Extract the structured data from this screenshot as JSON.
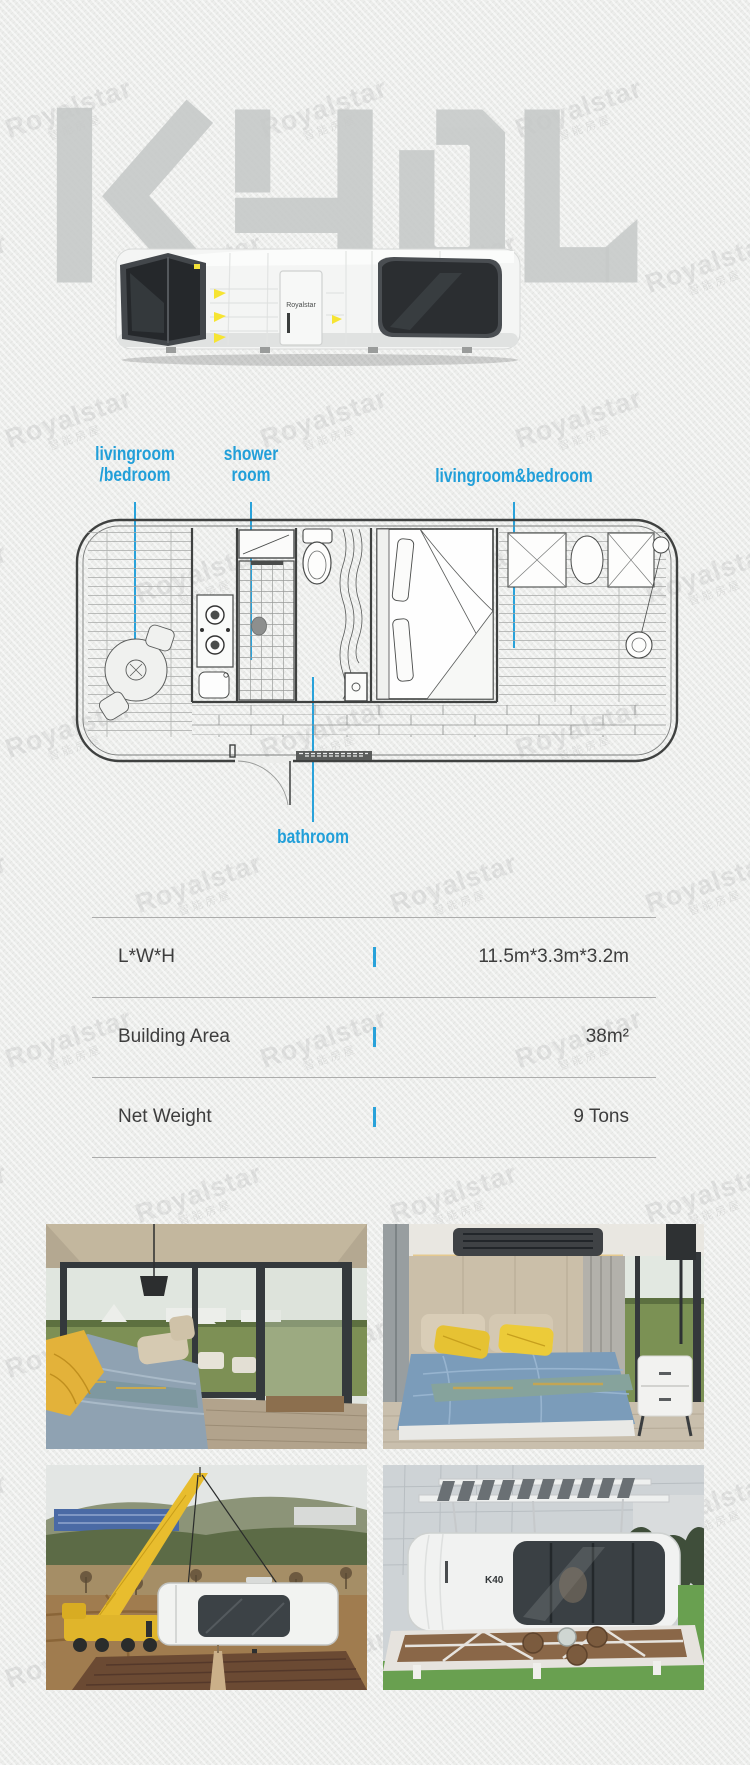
{
  "watermark": {
    "brand": "Royalstar",
    "subtext": "智能房屋"
  },
  "hero": {
    "model_code": "K40L"
  },
  "house_render": {
    "door_brand": "Royalstar"
  },
  "callouts": {
    "living1": {
      "line1": "livingroom",
      "line2": "/bedroom"
    },
    "shower": {
      "line1": "shower",
      "line2": "room"
    },
    "living2": {
      "line1": "livingroom&bedroom"
    },
    "bathroom": {
      "line1": "bathroom"
    }
  },
  "spec_table": {
    "rows": [
      {
        "label": "L*W*H",
        "value": "11.5m*3.3m*3.2m"
      },
      {
        "label": "Building Area",
        "value": "38m²"
      },
      {
        "label": "Net Weight",
        "value": "9 Tons"
      }
    ]
  },
  "photos": [
    {
      "alt": "interior living and bedroom with corner glass walls"
    },
    {
      "alt": "bedroom with blue bedding and yellow pillows"
    },
    {
      "alt": "crane lifting capsule house onto hillside site"
    },
    {
      "alt": "capsule house on white deck with solar canopy",
      "badge": "K40"
    }
  ],
  "colors": {
    "accent_blue": "#219fd9",
    "logo_gray": "#c6c9c8",
    "paper": "#ecedeb"
  }
}
